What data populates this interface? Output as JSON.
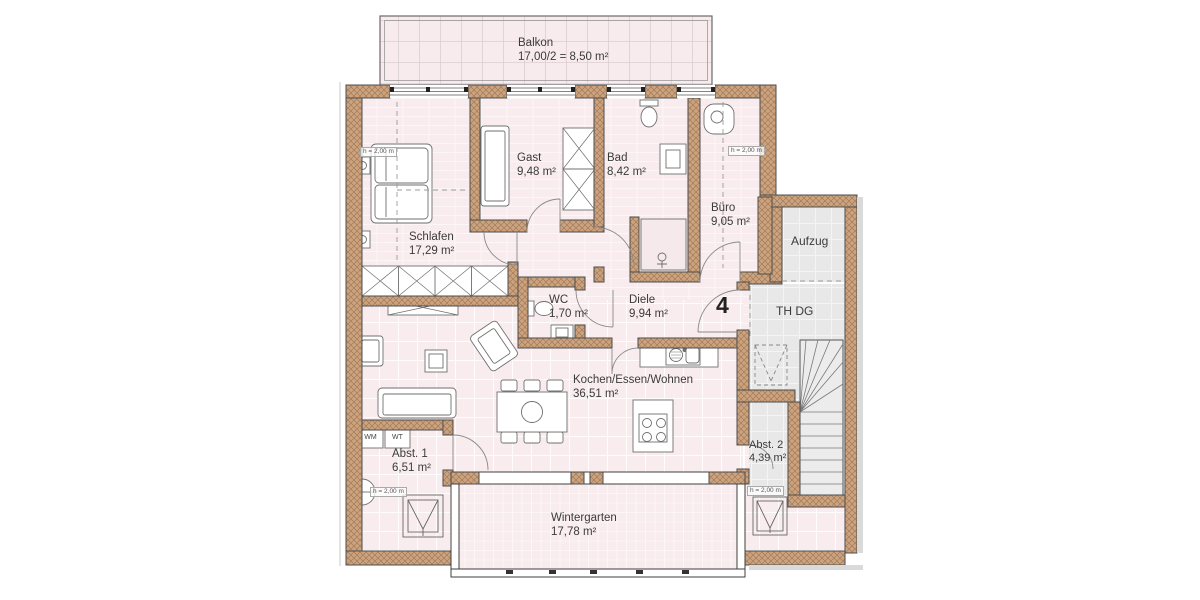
{
  "colors": {
    "floor_pink": "#f8ecee",
    "wall_tan": "#cda37f",
    "stair_gray": "#e9e9e9"
  },
  "rooms": {
    "balkon": {
      "name": "Balkon",
      "area": "17,00/2 = 8,50 m²"
    },
    "schlafen": {
      "name": "Schlafen",
      "area": "17,29 m²"
    },
    "gast": {
      "name": "Gast",
      "area": "9,48 m²"
    },
    "bad": {
      "name": "Bad",
      "area": "8,42 m²"
    },
    "buero": {
      "name": "Büro",
      "area": "9,05 m²"
    },
    "wc": {
      "name": "WC",
      "area": "1,70 m²"
    },
    "diele": {
      "name": "Diele",
      "area": "9,94 m²"
    },
    "kochen": {
      "name": "Kochen/Essen/Wohnen",
      "area": "36,51 m²"
    },
    "abst1": {
      "name": "Abst. 1",
      "area": "6,51 m²"
    },
    "abst2": {
      "name": "Abst. 2",
      "area": "4,39 m²"
    },
    "wintergarten": {
      "name": "Wintergarten",
      "area": "17,78 m²"
    },
    "aufzug": {
      "name": "Aufzug"
    },
    "thdg": {
      "name": "TH DG"
    }
  },
  "labels": {
    "unit_number": "4",
    "height_note": "h = 2,00 m",
    "washer": "WM",
    "dryer": "WT"
  }
}
